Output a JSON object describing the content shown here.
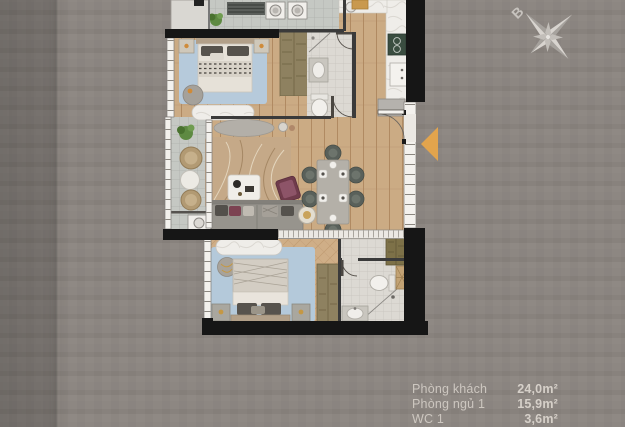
{
  "page": {
    "type": "apartment-floor-plan-rendering"
  },
  "palette": {
    "background": "#8b8580",
    "background_left_band": "#756f6a",
    "wall": "#161616",
    "wood_floor": "#cbab84",
    "tile_floor": "#c5c8c3",
    "wc_tile": "#dcd9d3",
    "rug_blue": "#b6cadb",
    "marble_counter": "#efede9",
    "wardrobe_wood": "#8e8160",
    "accent_orange": "#e2a44d",
    "legend_text": "#cdc7c0"
  },
  "compass": {
    "label": "B",
    "color": "#c7c3be"
  },
  "entrance_arrow": {
    "color": "#e2a44d",
    "direction": "left"
  },
  "legend": {
    "items": [
      {
        "label": "Phòng khách",
        "area": "24,0m²"
      },
      {
        "label": "Phòng ngủ 1",
        "area": "15,9m²"
      },
      {
        "label": "WC 1",
        "area": "3,6m²"
      }
    ]
  }
}
